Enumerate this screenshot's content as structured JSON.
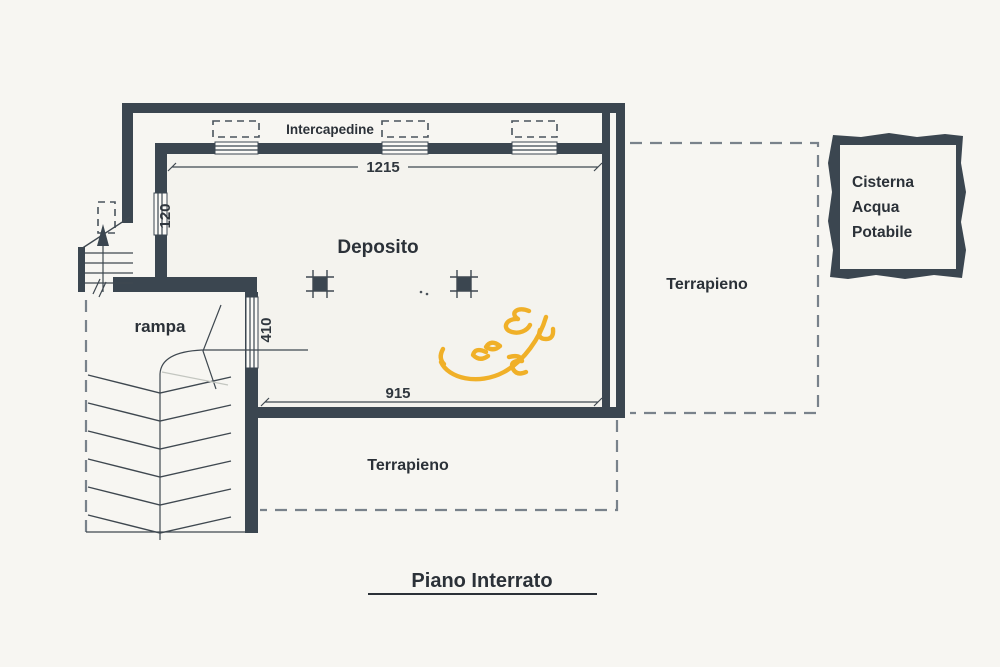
{
  "plan": {
    "title": "Piano Interrato",
    "labels": {
      "intercapedine": "Intercapedine",
      "deposito": "Deposito",
      "rampa": "rampa",
      "terrapieno_right": "Terrapieno",
      "terrapieno_bottom": "Terrapieno",
      "cisterna_line1": "Cisterna",
      "cisterna_line2": "Acqua",
      "cisterna_line3": "Potabile"
    },
    "dimensions": {
      "top_width": "1215",
      "interior_width": "915",
      "left_window": "120",
      "ramp_opening": "410"
    },
    "colors": {
      "wall": "#3b4650",
      "background": "#f7f6f2",
      "room_fill": "#f4f3ee",
      "dashed_line": "#79828b",
      "annotation": "#3f4850",
      "doodle_yellow": "#f0b028",
      "text": "#2b3138"
    }
  }
}
